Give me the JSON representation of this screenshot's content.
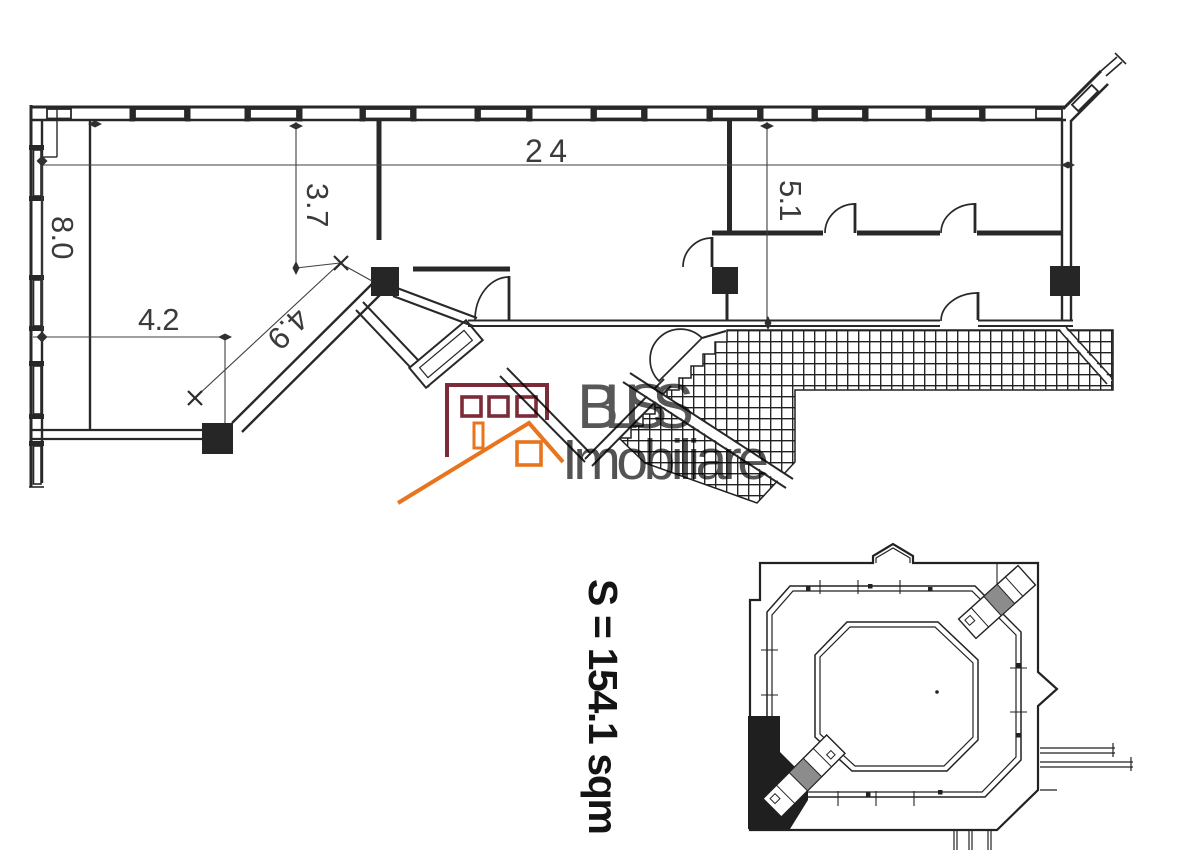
{
  "floor_plan": {
    "dimensions": [
      {
        "name": "total-width",
        "value": "24"
      },
      {
        "name": "upper-room-depth",
        "value": "3.7"
      },
      {
        "name": "right-room-depth",
        "value": "5.1"
      },
      {
        "name": "left-side-height",
        "value": "8.0"
      },
      {
        "name": "lower-left-width",
        "value": "4.2"
      },
      {
        "name": "diagonal-wall",
        "value": "4.9"
      }
    ],
    "area_label": "S = 154.1 sqm"
  },
  "watermark": {
    "brand": "BLISS",
    "tagline": "Imobiliare",
    "brand_text_color": "#404040",
    "building_color": "#7c2c38",
    "roof_color": "#e8751d"
  },
  "colors": {
    "wall": "#282828",
    "hatch": "#202020",
    "key_plan": "#222222",
    "wedge": "#1f1f1f"
  }
}
